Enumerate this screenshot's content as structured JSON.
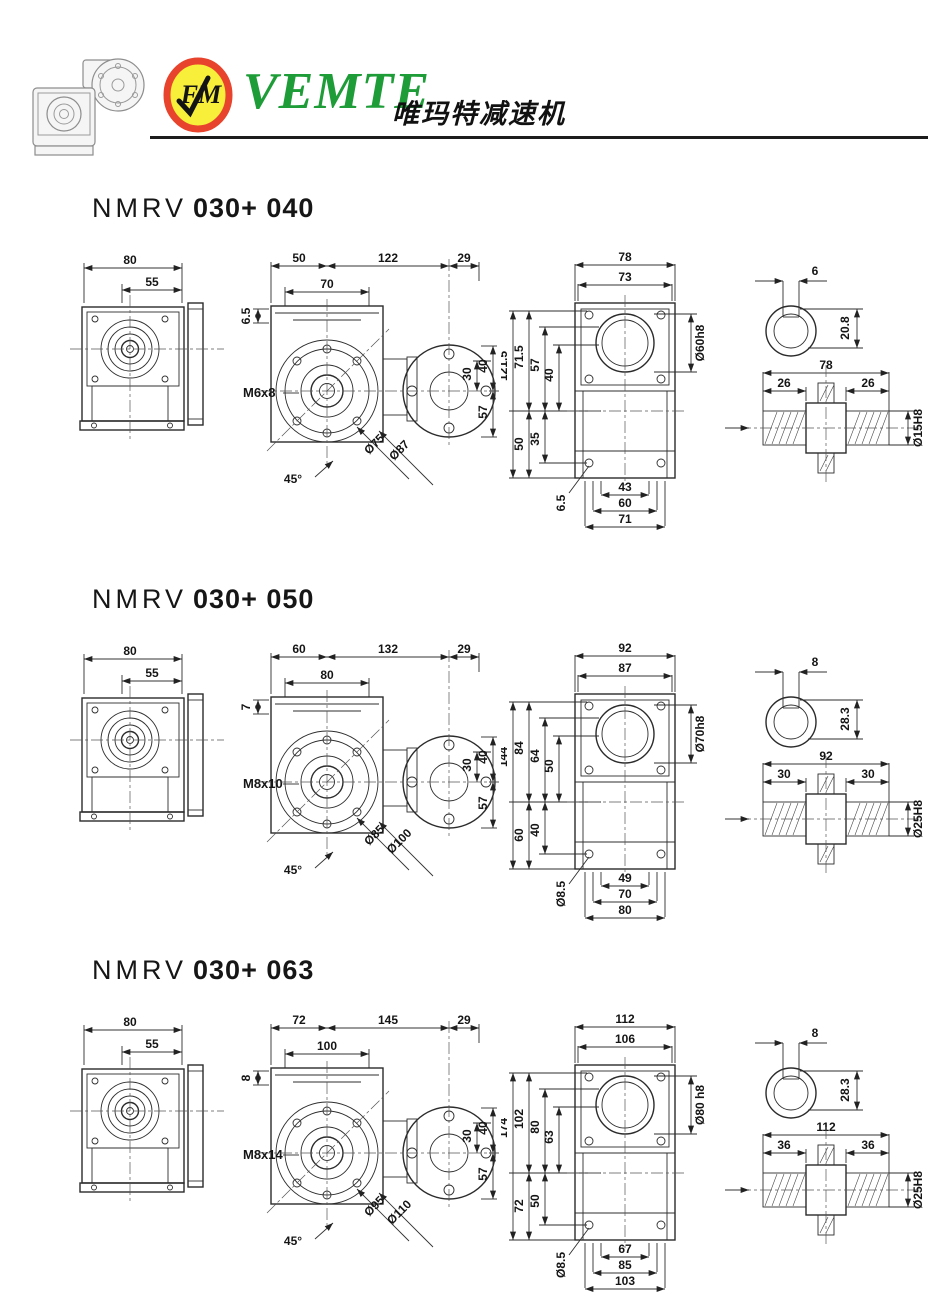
{
  "header": {
    "brand": "VEMTE",
    "brand_cn": "唯玛特减速机",
    "logo_text": "FM",
    "colors": {
      "brand_green": "#1e9c38",
      "logo_ring": "#e8432c",
      "logo_fill": "#f8ef3a"
    }
  },
  "sections": [
    {
      "title_prefix": "NMRV",
      "title_model": "030+ 040",
      "side": {
        "d_outer": "80",
        "d_inner": "55"
      },
      "front": {
        "top": [
          "50",
          "122",
          "29"
        ],
        "offset": "6.5",
        "inner": "70",
        "thread": "M6x8",
        "angle": "45°",
        "diam": [
          "Ø75",
          "Ø87"
        ],
        "right": [
          "40",
          "30",
          "57"
        ]
      },
      "back": {
        "top": [
          "78",
          "73"
        ],
        "left_top": [
          "121.5",
          "71.5",
          "57",
          "40"
        ],
        "left_bot": [
          "50",
          "35"
        ],
        "corner": "6.5",
        "bore": "Ø60h8",
        "bottom": [
          "43",
          "60",
          "71"
        ]
      },
      "shaft": {
        "key_w": "6",
        "key_d": "20.8",
        "len": "78",
        "ext": [
          "26",
          "26"
        ],
        "bore": "Ø15H8"
      }
    },
    {
      "title_prefix": "NMRV",
      "title_model": "030+ 050",
      "side": {
        "d_outer": "80",
        "d_inner": "55"
      },
      "front": {
        "top": [
          "60",
          "132",
          "29"
        ],
        "offset": "7",
        "inner": "80",
        "thread": "M8x10",
        "angle": "45°",
        "diam": [
          "Ø85",
          "Ø100"
        ],
        "right": [
          "40",
          "30",
          "57"
        ]
      },
      "back": {
        "top": [
          "92",
          "87"
        ],
        "left_top": [
          "144",
          "84",
          "64",
          "50"
        ],
        "left_bot": [
          "60",
          "40"
        ],
        "corner": "Ø8.5",
        "bore": "Ø70h8",
        "bottom": [
          "49",
          "70",
          "80"
        ]
      },
      "shaft": {
        "key_w": "8",
        "key_d": "28.3",
        "len": "92",
        "ext": [
          "30",
          "30"
        ],
        "bore": "Ø25H8"
      }
    },
    {
      "title_prefix": "NMRV",
      "title_model": "030+ 063",
      "side": {
        "d_outer": "80",
        "d_inner": "55"
      },
      "front": {
        "top": [
          "72",
          "145",
          "29"
        ],
        "offset": "8",
        "inner": "100",
        "thread": "M8x14",
        "angle": "45°",
        "diam": [
          "Ø95",
          "Ø110"
        ],
        "right": [
          "40",
          "30",
          "57"
        ]
      },
      "back": {
        "top": [
          "112",
          "106"
        ],
        "left_top": [
          "174",
          "102",
          "80",
          "63"
        ],
        "left_bot": [
          "72",
          "50"
        ],
        "corner": "Ø8.5",
        "bore": "Ø80 h8",
        "bottom": [
          "67",
          "85",
          "103"
        ]
      },
      "shaft": {
        "key_w": "8",
        "key_d": "28.3",
        "len": "112",
        "ext": [
          "36",
          "36"
        ],
        "bore": "Ø25H8"
      }
    }
  ]
}
